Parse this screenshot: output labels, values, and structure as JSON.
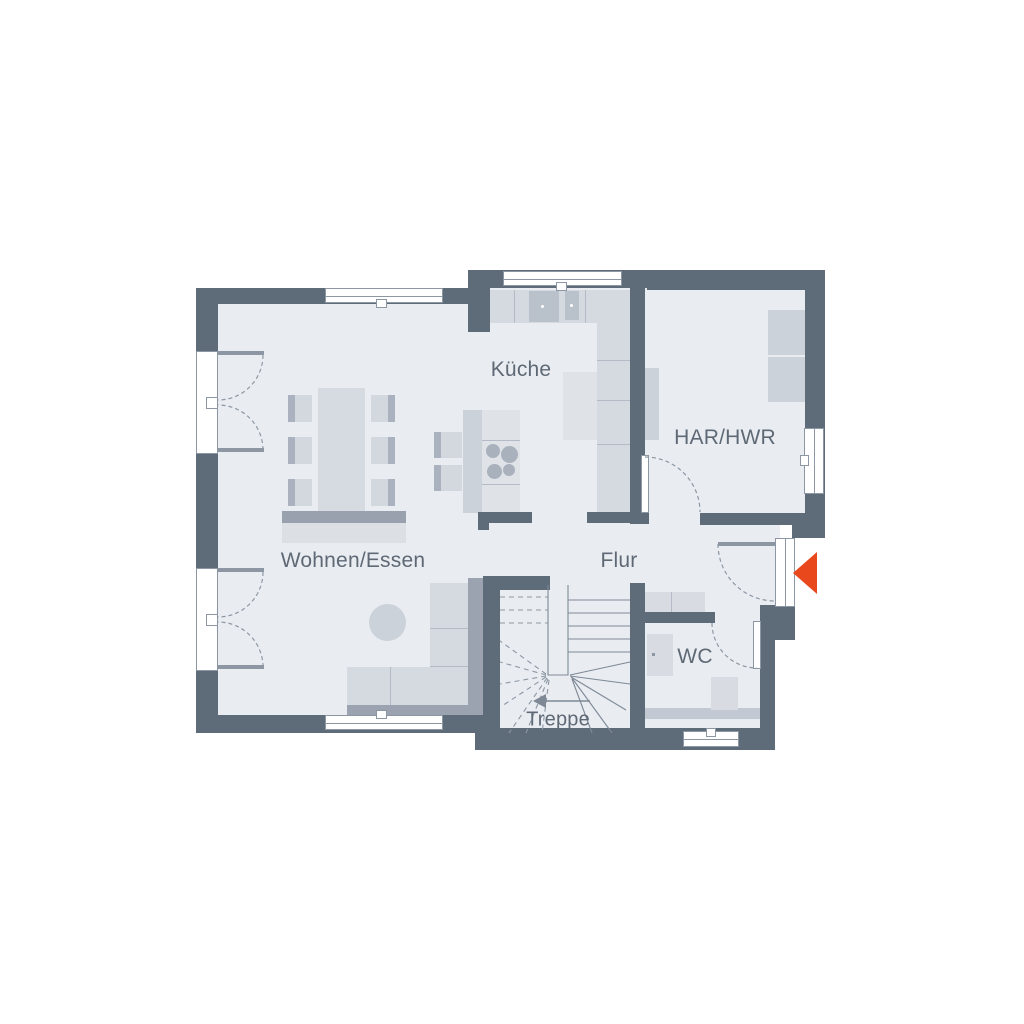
{
  "floor_plan": {
    "labels": {
      "kitchen": "Küche",
      "utility_room": "HAR/HWR",
      "living_dining": "Wohnen/Essen",
      "hallway": "Flur",
      "wc": "WC",
      "stairs": "Treppe"
    }
  },
  "colors": {
    "wall": "#5e6b79",
    "floor": "#e9edf2",
    "furniture_light": "#d6dbe2",
    "furniture_mid": "#c6ccd5",
    "furniture_dark": "#9aa3af",
    "line": "#8d97a3",
    "accent": "#e8481c",
    "label_text": "#5f6975",
    "background": "#ffffff"
  },
  "icons": {
    "entrance_arrow": "triangle-pointing-left"
  }
}
